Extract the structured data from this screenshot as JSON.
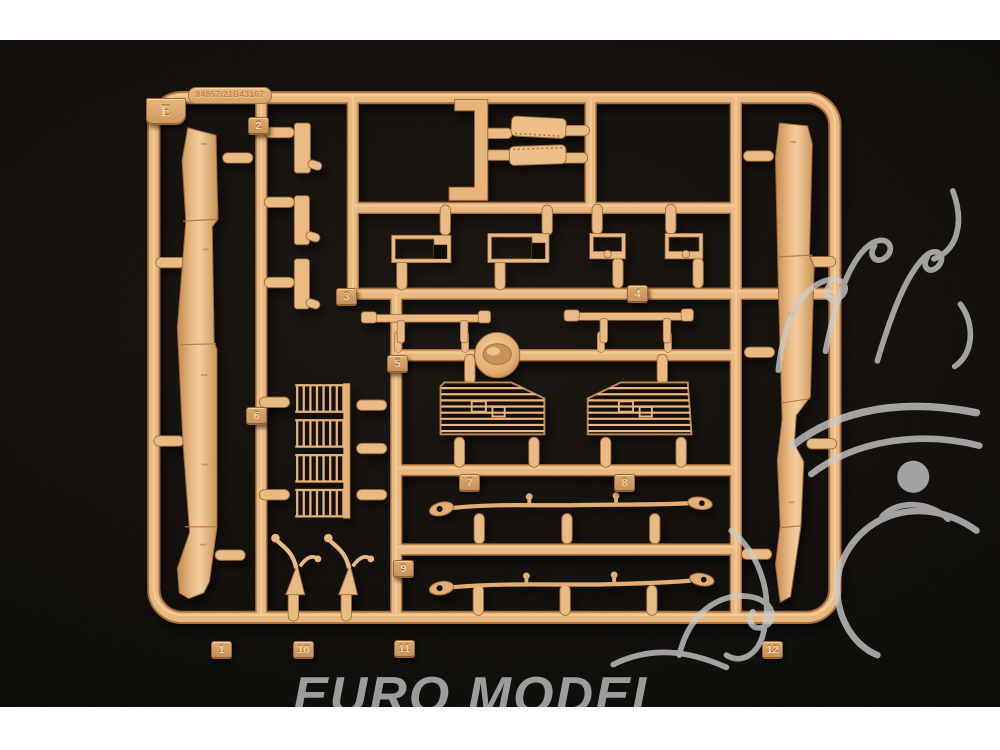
{
  "photo": {
    "description": "product photo of a tan plastic model-kit sprue on black velvet",
    "background_color": "#0c0a07",
    "sprue": {
      "letter_tab": "E",
      "mold_code": "84857/21B43107",
      "material_color": "#e8b67e",
      "part_numbers": [
        "1",
        "2",
        "3",
        "4",
        "5",
        "6",
        "7",
        "8",
        "9",
        "10",
        "11",
        "12"
      ]
    },
    "watermark": {
      "brand": "EURO MODEL",
      "logo": "dragon-outline",
      "color": "#c9c9c9"
    }
  }
}
